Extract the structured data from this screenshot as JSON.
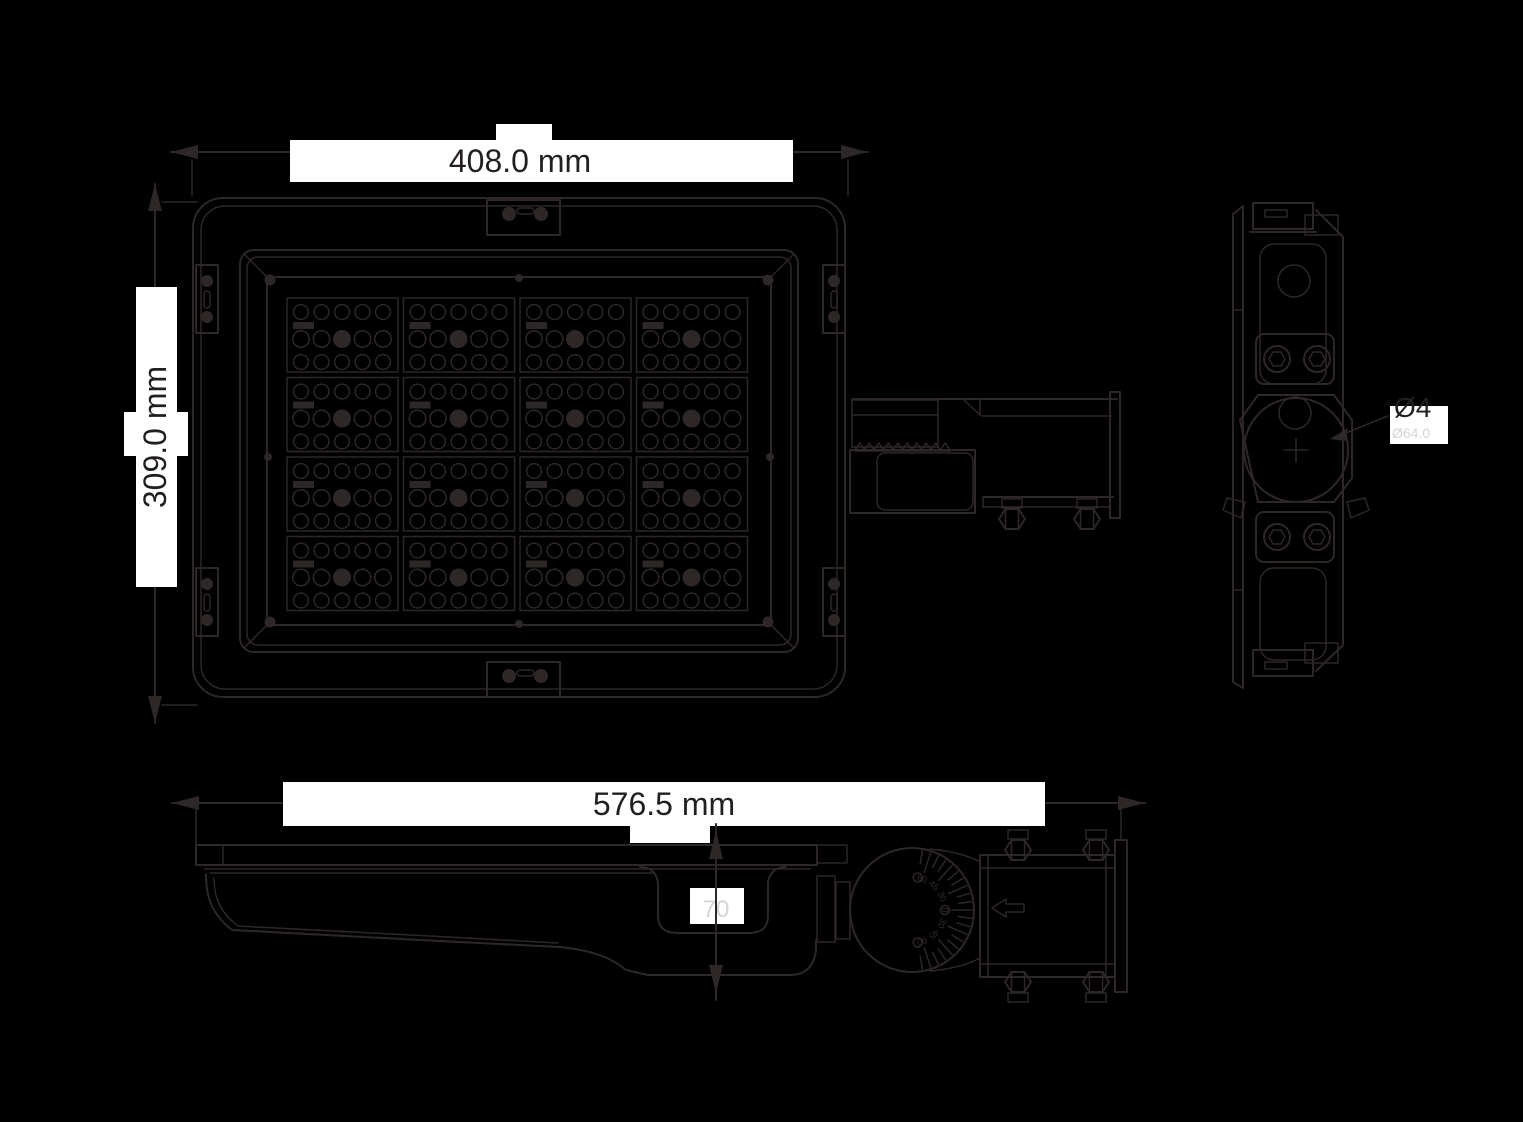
{
  "page": {
    "background": "#000000",
    "line_color": "#2e2727",
    "label_bg": "#ffffff",
    "dim_text_color": "#231f20",
    "faint_text_color": "#d4d4d4"
  },
  "dims": {
    "width": "408.0 mm",
    "height": "309.0 mm",
    "length": "576.5 mm",
    "arm_height": "70",
    "knuckle": "Ø4",
    "knuckle_faint": "Ø64.0"
  },
  "led_grid": {
    "rows": 4,
    "cols": 4,
    "circles_per_row": 5,
    "rows_per_module": 3
  },
  "dial": {
    "labels": [
      "60",
      "45",
      "30",
      "0",
      "30",
      "45",
      "60"
    ],
    "tick_count": 21,
    "angle_start": -80,
    "angle_end": 80
  },
  "views": {
    "front": "front view",
    "side": "side view",
    "profile": "profile view"
  }
}
